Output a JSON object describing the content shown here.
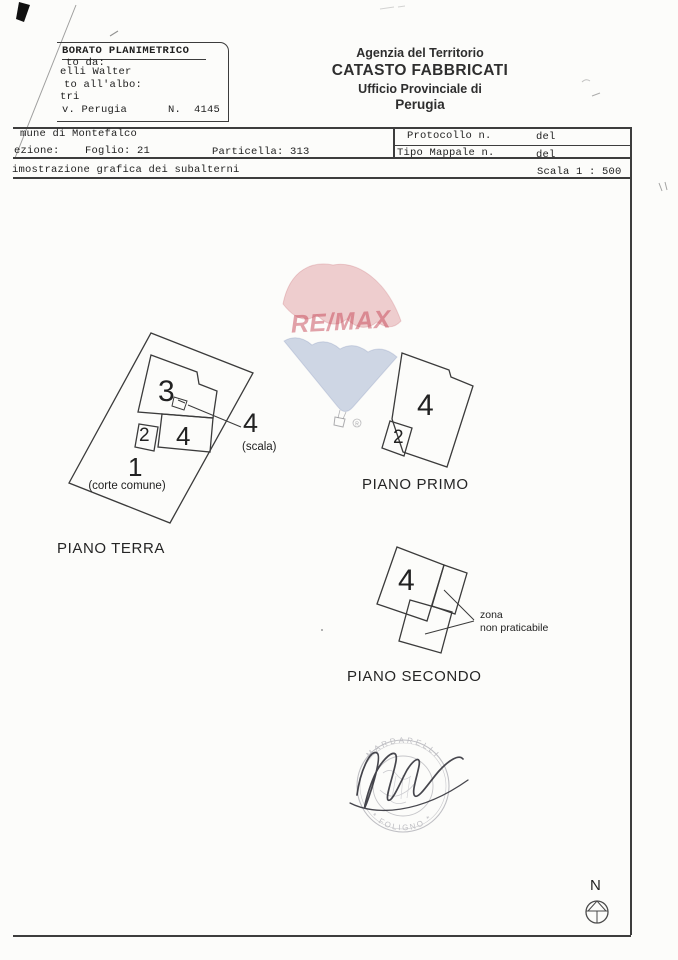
{
  "header": {
    "elaborato": {
      "title": "BORATO PLANIMETRICO",
      "row1": "to da:",
      "row2": "elli Walter",
      "row3": "to all'albo:",
      "row4": "tri",
      "row5": "v. Perugia",
      "number": "N.  4145"
    },
    "agency": {
      "line1": "Agenzia del Territorio",
      "line2": "CATASTO FABBRICATI",
      "line3": "Ufficio Provinciale di",
      "line4": "Perugia"
    },
    "location": {
      "comune": "mune di Montefalco",
      "sezione": "ezione:",
      "foglio": "Foglio: 21",
      "particella": "Particella: 313"
    },
    "protocol": {
      "protocollo_label": "Protocollo n.",
      "protocollo_value": "del",
      "mappale_label": "Tipo Mappale n.",
      "mappale_value": "del"
    },
    "caption": {
      "text": "imostrazione grafica dei subalterni",
      "scale": "Scala 1 : 500"
    }
  },
  "watermark": {
    "brand": "RE/MAX",
    "reg": "R",
    "red": "#c75f6b",
    "blue": "#8499c4"
  },
  "plans": {
    "terra": {
      "title": "PIANO TERRA",
      "court_number": "1",
      "court_note": "(corte comune)",
      "room3": "3",
      "room2": "2",
      "room4": "4",
      "stair_number": "4",
      "stair_note": "(scala)"
    },
    "primo": {
      "title": "PIANO PRIMO",
      "room4": "4",
      "room2": "2"
    },
    "secondo": {
      "title": "PIANO SECONDO",
      "room4": "4",
      "zona_line1": "zona",
      "zona_line2": "non praticabile"
    }
  },
  "stamp": {
    "arc_top": "MARDARELLI",
    "arc_bottom": "* FOLIGNO *"
  },
  "compass": {
    "label": "N"
  }
}
